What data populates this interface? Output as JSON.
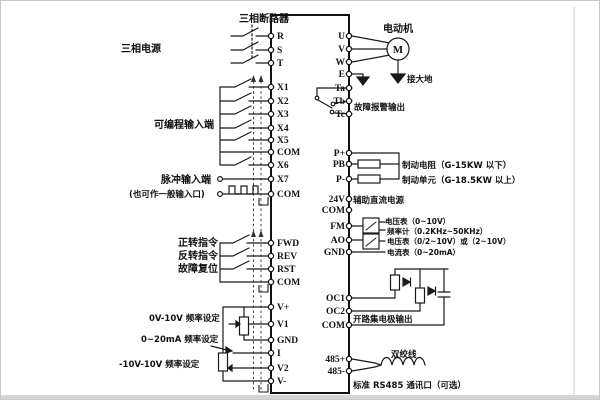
{
  "colors": {
    "line": "#1a1a1a",
    "background": "#ffffff",
    "page_edge": "#d4d4d4"
  },
  "terminals": {
    "left": [
      "R",
      "S",
      "T",
      "X1",
      "X2",
      "X3",
      "X4",
      "X5",
      "COM",
      "X6",
      "X7",
      "COM",
      "FWD",
      "REV",
      "RST",
      "COM",
      "V+",
      "V1",
      "GND",
      "I",
      "V2",
      "V-"
    ],
    "right": [
      "U",
      "V",
      "W",
      "E",
      "Ta",
      "Tb",
      "Tc",
      "P+",
      "PB",
      "P-",
      "24V",
      "COM",
      "FM",
      "AO",
      "GND",
      "OC1",
      "OC2",
      "COM",
      "485+",
      "485-"
    ]
  },
  "labels": {
    "breaker": "三相断路器",
    "power": "三相电源",
    "programmable_inputs": "可编程输入端",
    "pulse_input": "脉冲输入端",
    "pulse_input_note": "(也可作一般输入口)",
    "forward_cmd": "正转指令",
    "reverse_cmd": "反转指令",
    "fault_reset": "故障复位",
    "freq_set_0_10v": "0V-10V 频率设定",
    "freq_set_0_20ma": "0~20mA 频率设定",
    "freq_set_pm10v": "-10V-10V 频率设定",
    "motor": "电动机",
    "motor_m": "M",
    "earth": "接大地",
    "fault_alarm": "故障报警输出",
    "brake_resistor": "制动电阻（G-15KW 以下）",
    "brake_unit": "制动单元（G-18.5KW 以上）",
    "aux_dc": "辅助直流电源",
    "meter_volt1": "电压表（0~10V）",
    "meter_freq": "频率计（0.2KHz~50KHz）",
    "meter_volt2": "电压表（0/2~10V）或（2~10V）",
    "meter_amp": "电流表（0~20mA）",
    "open_collector": "开路集电极输出",
    "twisted_pair": "双绞线",
    "rs485": "标准 RS485 通讯口（可选）"
  }
}
